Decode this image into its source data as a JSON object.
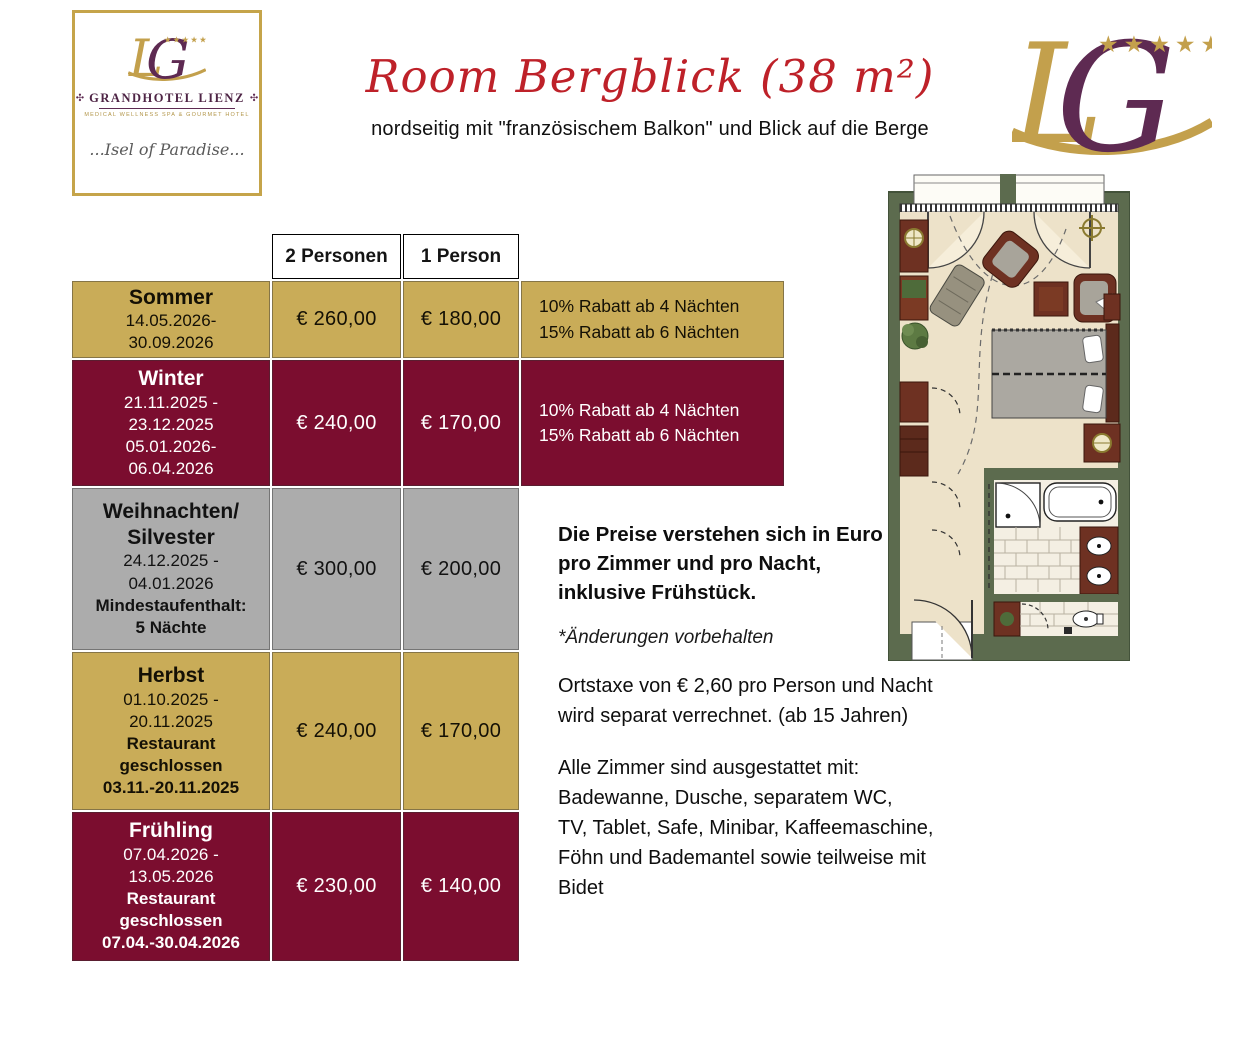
{
  "colors": {
    "gold": "#C9AC58",
    "maroon": "#7B0D2F",
    "gray": "#ACACAC",
    "title_red": "#BE2129",
    "logo_gold": "#C3A04C",
    "logo_plum": "#5E2A52"
  },
  "logo_card": {
    "hotel_name": "GRANDHOTEL LIENZ",
    "tagline": "MEDICAL WELLNESS SPA & GOURMET HOTEL",
    "slogan": "...Isel of Paradise...",
    "stars": "★★★★★",
    "ornament": "✣"
  },
  "brand_mark": {
    "stars": "★★★★★"
  },
  "header": {
    "title": "Room Bergblick (38 m²)",
    "subtitle": "nordseitig mit \"französischem Balkon\" und Blick auf die Berge"
  },
  "pricing": {
    "col_header_2p": "2 Personen",
    "col_header_1p": "1 Person",
    "rows": [
      {
        "id": "sommer",
        "theme": "gold",
        "height": 77,
        "title": "Sommer",
        "details": "14.05.2026-\n30.09.2026",
        "foot": "",
        "price_2p": "€ 260,00",
        "price_1p": "€ 180,00",
        "note": "10% Rabatt ab 4 Nächten\n15% Rabatt ab 6 Nächten"
      },
      {
        "id": "winter",
        "theme": "maroon",
        "height": 126,
        "title": "Winter",
        "details": "21.11.2025 -\n23.12.2025\n05.01.2026-\n06.04.2026",
        "foot": "",
        "price_2p": "€ 240,00",
        "price_1p": "€ 170,00",
        "note": "10% Rabatt ab 4 Nächten\n15% Rabatt ab 6 Nächten"
      },
      {
        "id": "weihnachten-silvester",
        "theme": "gray",
        "height": 162,
        "title": "Weihnachten/\nSilvester",
        "details": "24.12.2025 -\n04.01.2026",
        "foot": "Mindestaufenthalt:\n5 Nächte",
        "price_2p": "€ 300,00",
        "price_1p": "€ 200,00",
        "note": ""
      },
      {
        "id": "herbst",
        "theme": "gold",
        "height": 158,
        "title": "Herbst",
        "details": "01.10.2025 -\n20.11.2025",
        "foot": "Restaurant\ngeschlossen\n03.11.-20.11.2025",
        "price_2p": "€ 240,00",
        "price_1p": "€ 170,00",
        "note": ""
      },
      {
        "id": "fruehling",
        "theme": "maroon",
        "height": 149,
        "title": "Frühling",
        "details": "07.04.2026 -\n13.05.2026",
        "foot": "Restaurant\ngeschlossen\n07.04.-30.04.2026",
        "price_2p": "€ 230,00",
        "price_1p": "€ 140,00",
        "note": ""
      }
    ]
  },
  "info": {
    "pricing_note": "Die Preise verstehen sich in Euro\npro Zimmer und pro Nacht,\ninklusive Frühstück.",
    "disclaimer": "*Änderungen vorbehalten",
    "city_tax": "Ortstaxe von € 2,60 pro Person und Nacht\nwird separat verrechnet. (ab 15 Jahren)",
    "amenities": "Alle Zimmer sind ausgestattet mit:\nBadewanne, Dusche, separatem WC,\nTV, Tablet, Safe, Minibar, Kaffeemaschine,\nFöhn und Bademantel sowie teilweise mit\nBidet"
  }
}
